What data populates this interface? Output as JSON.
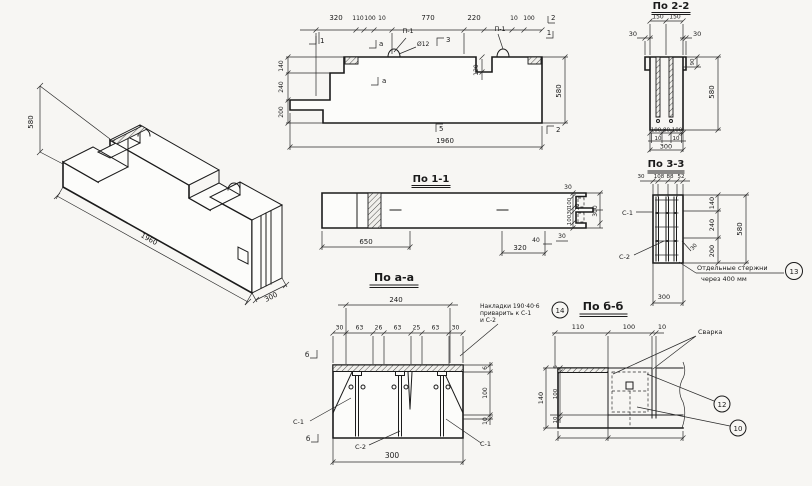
{
  "iso": {
    "dim_height": "580",
    "dim_length": "1960",
    "dim_width": "300"
  },
  "elevation": {
    "top_dims": [
      "320",
      "110",
      "100",
      "10",
      "770",
      "220",
      "10",
      "100"
    ],
    "left_dims": [
      "140",
      "240",
      "200"
    ],
    "dim_height": "580",
    "dim_length": "1960",
    "dim_notch": "120",
    "loop_label_1": "П-1",
    "loop_label_2": "П-1",
    "loop_dia": "Ø12",
    "markers": {
      "m1_left": "1",
      "m2_top": "2",
      "m1_right": "1",
      "m2_bottom": "2",
      "m3": "3",
      "m5": "5",
      "ma_top": "а",
      "ma_bottom": "а"
    }
  },
  "sec11": {
    "title": "По 1-1",
    "dim_650": "650",
    "dim_320": "320",
    "dim_40": "40",
    "dim_30_top": "30",
    "dim_30_bottom": "30",
    "chain": [
      "100",
      "10",
      "30",
      "100"
    ],
    "dim_total": "300"
  },
  "sec22": {
    "title": "По 2-2",
    "dim_150a": "150",
    "dim_150b": "150",
    "dim_30l": "30",
    "dim_30r": "30",
    "dim_90": "90",
    "dim_580": "580",
    "bottom_chain": [
      "100",
      "80",
      "100"
    ],
    "bottom_small": [
      "10",
      "10"
    ],
    "dim_300": "300"
  },
  "sec33": {
    "title": "По 3-3",
    "top_dims": [
      "30",
      "108",
      "88",
      "52"
    ],
    "right_dims": [
      "140",
      "240",
      "200"
    ],
    "dim_580": "580",
    "dim_30": "30",
    "label_c1": "С-1",
    "label_c2": "С-2",
    "note_line1": "Отдельные стержни",
    "note_line2": "через 400 мм",
    "note_ref": "13",
    "dim_300": "300"
  },
  "secAA": {
    "title": "По а-а",
    "dim_240": "240",
    "chain": [
      "30",
      "63",
      "26",
      "63",
      "25",
      "63",
      "30"
    ],
    "right_dims": [
      "6",
      "100",
      "10"
    ],
    "dim_300": "300",
    "label_c1_left": "С-1",
    "label_c2": "С-2",
    "label_c1_right": "С-1",
    "marker_b_top": "б",
    "marker_b_bottom": "б",
    "note_line1": "Накладки 190·40·6",
    "note_line2": "приварить к С-1",
    "note_line3": "и С-2",
    "note_ref": "14"
  },
  "secBB": {
    "title": "По б-б",
    "top_dims": [
      "110",
      "100",
      "10"
    ],
    "left_dims": [
      "6",
      "100",
      "10"
    ],
    "dim_140": "140",
    "label_weld": "Сварка",
    "ref_plate": "12",
    "ref_bar": "10"
  }
}
